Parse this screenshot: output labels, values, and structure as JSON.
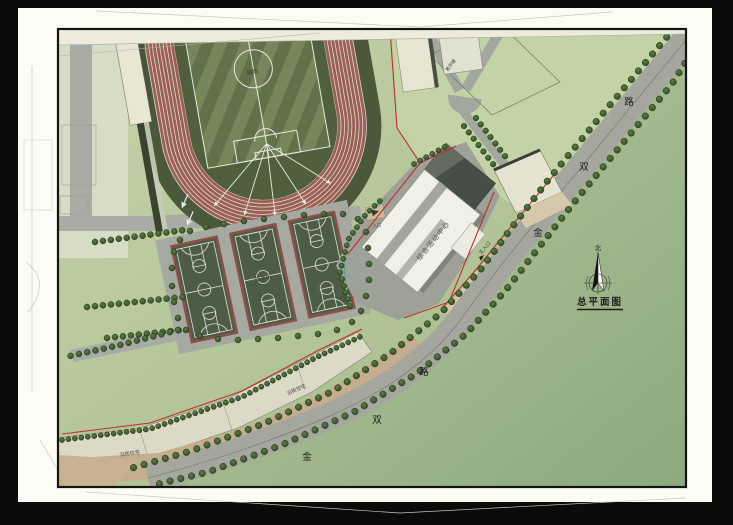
{
  "sheet": {
    "plan_title": "总平面图",
    "north_label": "北"
  },
  "road": {
    "name": "金双路",
    "char_jin": "金",
    "char_shuang": "双",
    "char_lu": "路"
  },
  "labels": {
    "field": "操场",
    "basketball": "篮球场",
    "gym": "综合活动中心",
    "residential": "沿街住宅",
    "main_entrance": "主入口",
    "secondary_entrance": "入口",
    "ne_building": "教学楼"
  },
  "colors": {
    "paper": "#fdfdf6",
    "site_green": "#b2c497",
    "track_red": "#9b6055",
    "court_green": "#4d5d45",
    "court_border": "#8e4e4a",
    "road_gray": "#a5a79f",
    "boundary_red": "#c03026",
    "building_white": "#f0efe8",
    "sidewalk_tan": "#d4c5a6"
  }
}
